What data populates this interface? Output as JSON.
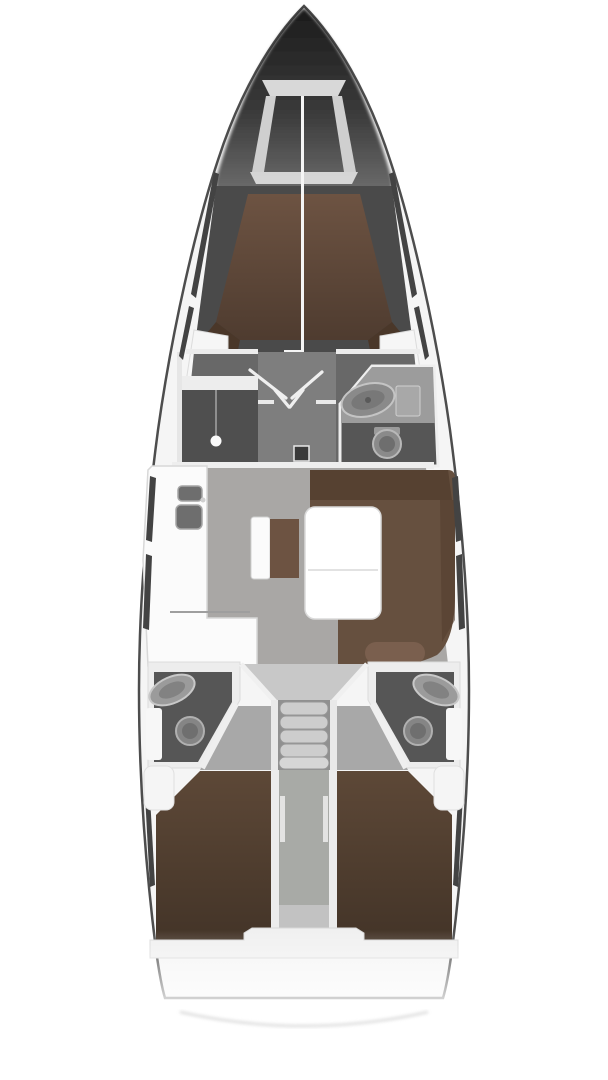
{
  "diagram": {
    "kind": "yacht-interior-floorplan",
    "orientation": "bow-up",
    "canvas": {
      "width": 608,
      "height": 1080
    },
    "rooms": [
      {
        "id": "anchor-locker",
        "fixtures": []
      },
      {
        "id": "forward-cabin",
        "fixtures": [
          "double-berth"
        ]
      },
      {
        "id": "wardrobe",
        "fixtures": [
          "hanging-lamp"
        ]
      },
      {
        "id": "forward-head",
        "fixtures": [
          "sink",
          "toilet"
        ]
      },
      {
        "id": "salon",
        "fixtures": [
          "dinette-sofa",
          "table",
          "bench"
        ]
      },
      {
        "id": "galley",
        "fixtures": [
          "sink-basin",
          "sink-basin",
          "counter"
        ]
      },
      {
        "id": "companionway",
        "fixtures": [
          "steps"
        ]
      },
      {
        "id": "port-aft-head",
        "fixtures": [
          "sink",
          "toilet"
        ]
      },
      {
        "id": "starboard-aft-head",
        "fixtures": [
          "sink",
          "toilet"
        ]
      },
      {
        "id": "port-aft-cabin",
        "fixtures": [
          "double-berth"
        ]
      },
      {
        "id": "starboard-aft-cabin",
        "fixtures": [
          "double-berth"
        ]
      }
    ],
    "fixture_counts": {
      "toilets": 3,
      "sinks": 5,
      "berths": 3,
      "companionway_steps": 5
    }
  },
  "colors": {
    "hull_line": "#4d4d4d",
    "deck": "#f5f5f5",
    "bow_dark": "#262626",
    "structure_dark": "#4a4a4a",
    "wall_white": "#eeeeee",
    "furniture_white": "#fbfbfb",
    "floor_gray": "#a9a7a5",
    "corridor_gray": "#7e7e7e",
    "room_dark": "#565656",
    "wardrobe_dark": "#4f4f4f",
    "counter_gray": "#9c9c9c",
    "fixture_gray": "#8a8a8a",
    "fixture_rim": "#c4c4c4",
    "berth_brown": "#6d5342",
    "berth_brown_dark": "#4a3729",
    "sofa_brown": "#66503f",
    "sofa_back": "#533e2f",
    "cushion_brown": "#7a5f4e",
    "aft_berth_brown": "#5d4837",
    "landing_gray": "#c8c8c8",
    "step_gray": "#cdcdcd",
    "stairwell_gray": "#909090",
    "walkway_gray": "#a8aaa6",
    "window_dark": "#434343",
    "locker_light": "#d8d8d8",
    "transom_line": "#cccccc"
  }
}
